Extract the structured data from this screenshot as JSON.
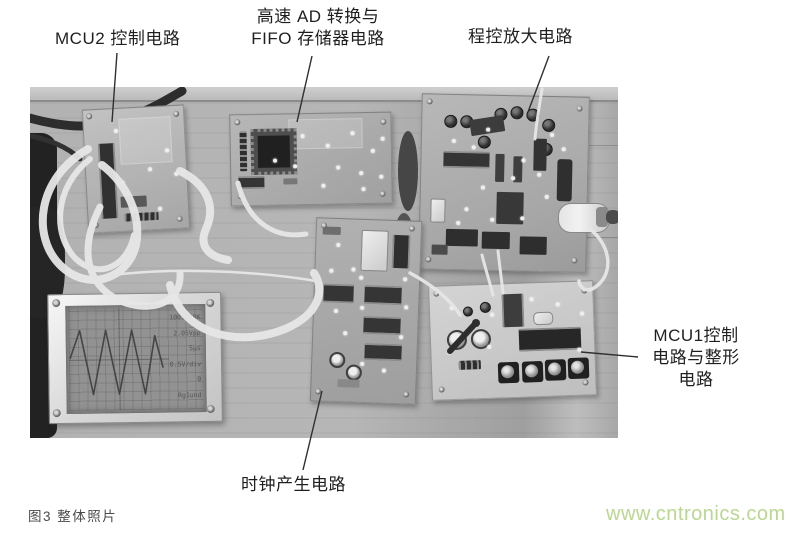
{
  "figure": {
    "caption": "图3 整体照片",
    "watermark": "www.cntronics.com"
  },
  "annotations": {
    "mcu2": "MCU2 控制电路",
    "ad_fifo": {
      "line1": "高速 AD 转换与",
      "line2": "FIFO 存储器电路"
    },
    "amp": "程控放大电路",
    "mcu1": {
      "line1": "MCU1控制",
      "line2": "电路与整形",
      "line3": "电路"
    },
    "clock": "时钟产生电路"
  },
  "photo": {
    "lcd_readout": [
      "100.000K",
      "2.05Vpp",
      "5μs",
      "0.5V/div",
      "0",
      "Rg1und"
    ]
  },
  "colors": {
    "watermark_green": "#bad791",
    "caption_gray": "#4a4a4a",
    "label_black": "#1f1f1f"
  }
}
